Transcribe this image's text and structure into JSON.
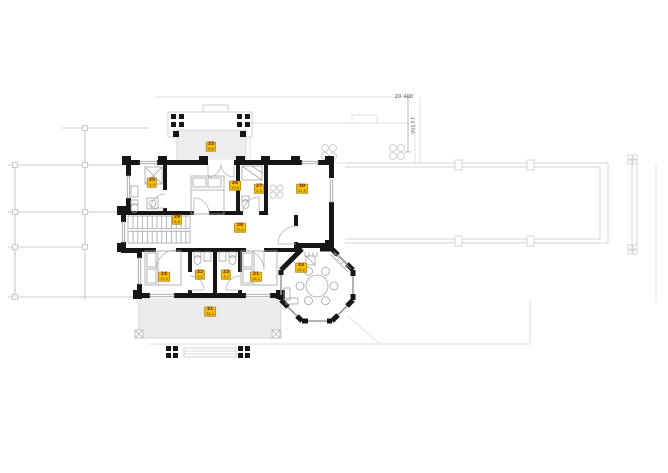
{
  "plan": {
    "title": "upper-floor-plan",
    "dim_width_label": "20 400",
    "dim_height_label": "13 500"
  },
  "rooms": [
    {
      "id": "balcony",
      "number": "35",
      "area": "8,6",
      "x": 211,
      "y": 147
    },
    {
      "id": "bathroom-top",
      "number": "25",
      "area": "4,9",
      "x": 152,
      "y": 183
    },
    {
      "id": "bedroom-top",
      "number": "26",
      "area": "15,6",
      "x": 235,
      "y": 186
    },
    {
      "id": "bathroom-small",
      "number": "27",
      "area": "4,3",
      "x": 259,
      "y": 189
    },
    {
      "id": "room-right",
      "number": "30",
      "area": "21,9",
      "x": 302,
      "y": 189
    },
    {
      "id": "stairs",
      "number": "29",
      "area": "6,8",
      "x": 177,
      "y": 220
    },
    {
      "id": "hall",
      "number": "28",
      "area": "15,2",
      "x": 240,
      "y": 228
    },
    {
      "id": "bedroom-left",
      "number": "24",
      "area": "15,9",
      "x": 164,
      "y": 277
    },
    {
      "id": "bathroom-1",
      "number": "22",
      "area": "3,2",
      "x": 200,
      "y": 275
    },
    {
      "id": "bathroom-2",
      "number": "23",
      "area": "3,2",
      "x": 226,
      "y": 275
    },
    {
      "id": "bedroom-right",
      "number": "21",
      "area": "16,1",
      "x": 256,
      "y": 277
    },
    {
      "id": "lounge-octagon",
      "number": "33",
      "area": "19,2",
      "x": 301,
      "y": 268
    },
    {
      "id": "terrace",
      "number": "31",
      "area": "38,4",
      "x": 210,
      "y": 312
    }
  ],
  "colors": {
    "label_bg": "#f2c200",
    "label_text": "#7a1f00",
    "wall": "#161616",
    "faint_line": "#dcdcdc",
    "pergola_line": "#cbcbcb",
    "furniture_line": "#a3a3a3"
  }
}
